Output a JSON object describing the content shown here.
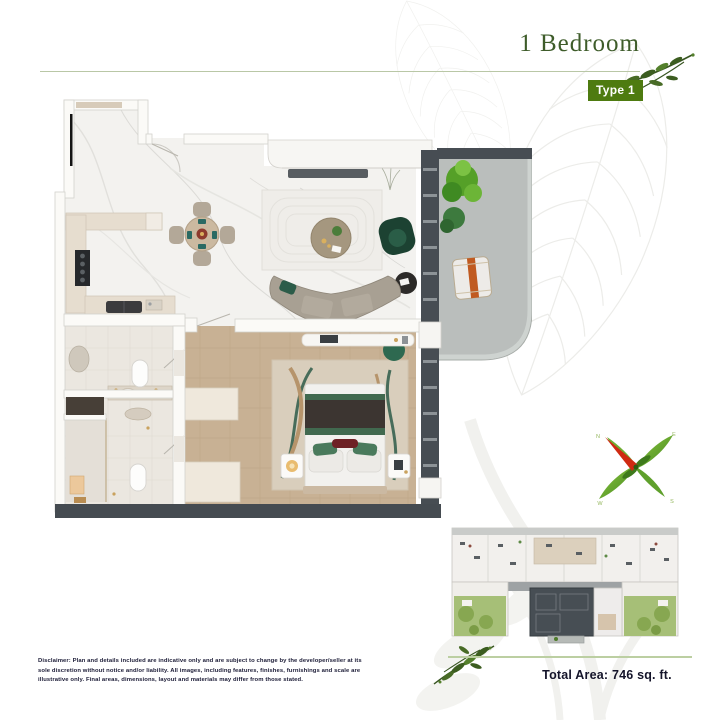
{
  "header": {
    "title": "1 Bedroom",
    "type_badge": "Type 1"
  },
  "summary": {
    "total_area": "Total Area: 746 sq. ft."
  },
  "disclaimer": "Disclaimer: Plan and details included are indicative only and are subject to change by the developer/seller at its sole discretion without notice and/or liability. All images, including features, finishes, furnishings and scale are illustrative only. Final areas, dimensions, layout and materials may differ from those stated.",
  "compass": {
    "n": "N",
    "e": "E",
    "s": "S",
    "w": "W"
  },
  "decorations": {
    "header_branch": "leaf-branch-icon",
    "footer_branch": "leaf-branch-icon",
    "compass": "leaf-compass-icon",
    "watermark": "leaf-skeleton-watermark"
  },
  "colors": {
    "badge_green": "#4e7b10",
    "title_green": "#3e5c2a",
    "separator_green": "#b9c7a6",
    "text_dark": "#14142a",
    "leaf_dark_green": "#3c5d20",
    "wall_charcoal": "#474d53",
    "wood_floor": "#c8b194",
    "balcony_concrete": "#babebc",
    "garden_green": "#a6bf77"
  }
}
